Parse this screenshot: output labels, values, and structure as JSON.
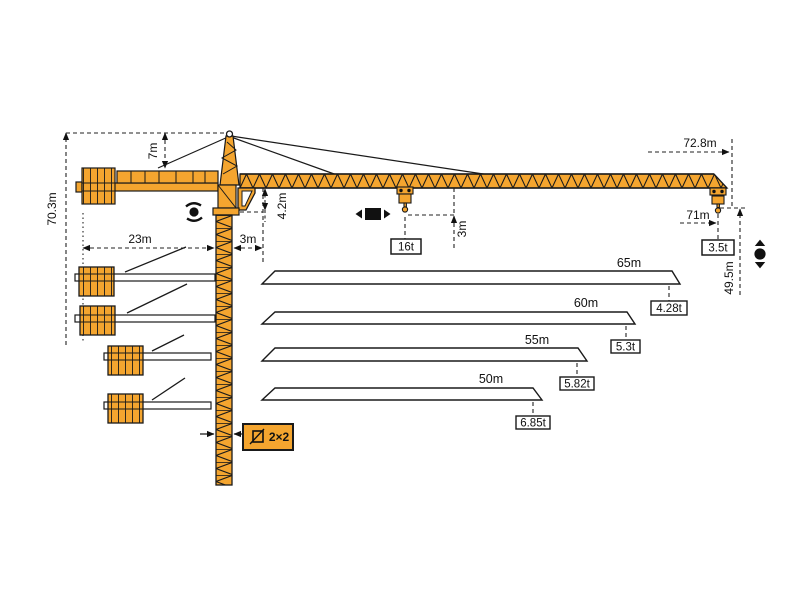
{
  "colors": {
    "crane_orange": "#F4A52F",
    "outline": "#1a1a1a",
    "background": "#ffffff"
  },
  "dims": {
    "overall_height": "70.3m",
    "head_height": "7m",
    "counterjib_radius": "23m",
    "rear_offset": "3m",
    "jib_underside_offset": "4.2m",
    "max_capacity": "16t",
    "hook_clearance": "3m",
    "tip_radius": "72.8m",
    "max_hook_radius": "71m",
    "tip_capacity": "3.5t",
    "hook_height": "49.5m",
    "mast_section": "2×2"
  },
  "load_chart": {
    "rows": [
      {
        "jib_length": "65m",
        "capacity": "4.28t"
      },
      {
        "jib_length": "60m",
        "capacity": "5.3t"
      },
      {
        "jib_length": "55m",
        "capacity": "5.82t"
      },
      {
        "jib_length": "50m",
        "capacity": "6.85t"
      }
    ]
  },
  "symbols": {
    "slewing": "slewing-rotation-icon",
    "trolley": "trolley-travel-icon",
    "hoist": "hoist-up-down-icon",
    "mast_section": "mast-cross-section-icon"
  },
  "chart_data": {
    "type": "table",
    "title": "Tower crane jib length vs tip capacity",
    "columns": [
      "jib_length_m",
      "tip_load_t"
    ],
    "rows": [
      [
        65,
        4.28
      ],
      [
        60,
        5.3
      ],
      [
        55,
        5.82
      ],
      [
        50,
        6.85
      ]
    ],
    "max_capacity_t": 16,
    "tip_capacity_at_71m_t": 3.5,
    "overall_height_m": 70.3,
    "hook_height_m": 49.5,
    "tip_radius_m": 72.8
  }
}
